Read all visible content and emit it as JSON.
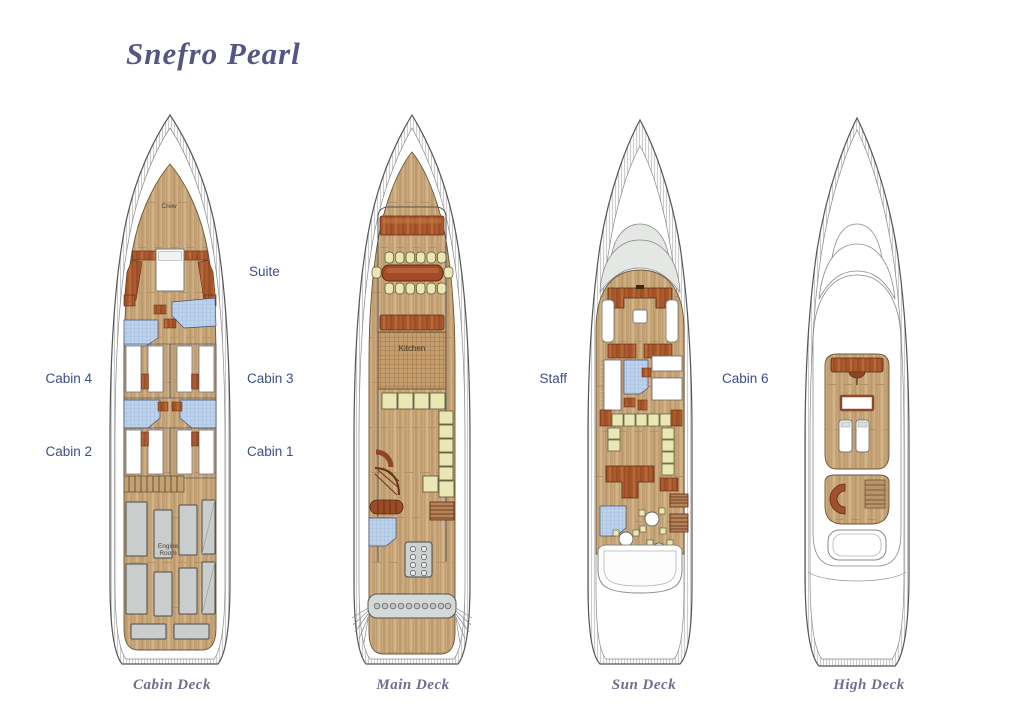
{
  "title": "Snefro Pearl",
  "deck_captions": {
    "cabin": "Cabin Deck",
    "main": "Main Deck",
    "sun": "Sun Deck",
    "high": "High Deck"
  },
  "cabin_labels": {
    "suite": "Suite",
    "cabin4": "Cabin 4",
    "cabin3": "Cabin 3",
    "cabin2": "Cabin 2",
    "cabin1": "Cabin 1",
    "staff": "Staff",
    "cabin6": "Cabin 6"
  },
  "room_labels": {
    "crew": "Crew",
    "engine_line1": "Engine",
    "engine_line2": "Room",
    "kitchen": "Kitchen"
  },
  "palette": {
    "title_violet": "#565685",
    "label_blue": "#3c4e86",
    "caption_gray": "#6e6e8e",
    "wood_light": "#c9a87c",
    "wood_dark": "#ab5a2e",
    "table_red_brown": "#a34a28",
    "tile_blue": "#bed2ea",
    "seat_cream": "#eae7b4",
    "machine_gray": "#c9cdcc",
    "windshield_gray": "#e4e7e4"
  }
}
